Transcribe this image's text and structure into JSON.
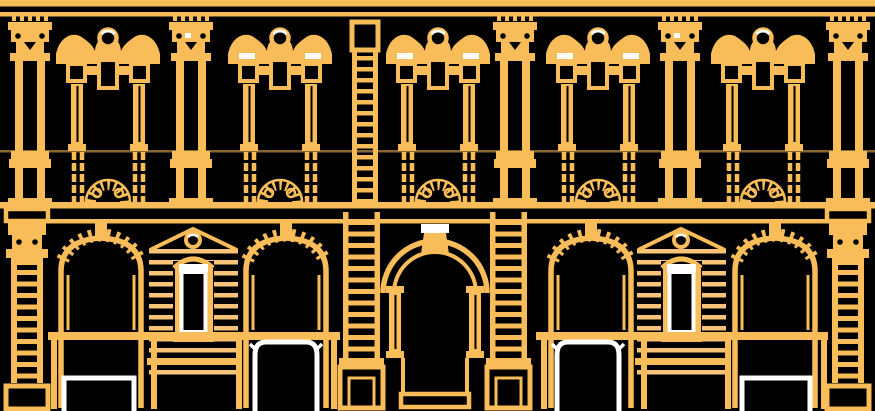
{
  "scene": {
    "type": "architectural-elevation-line-drawing",
    "subject": "two-story baroque palazzo facade, gold line art on black",
    "background_color": "#000000",
    "palette": {
      "gold": "#F8BC58",
      "pale_gold": "#F9C477",
      "white": "#FFFFFF",
      "black": "#000000"
    }
  },
  "facade": {
    "upper_floor": {
      "pilasters": 5,
      "french_windows": 5,
      "scroll_pediments": 5,
      "pediment_medallions": 5,
      "rusticated_quoin_chain": 1,
      "balcony_railing_bays": 5,
      "white_highlight_ticks_on_windows": 3
    },
    "ground_floor": {
      "corner_pilasters": 2,
      "arched_openings": 4,
      "rusticated_panels": 2,
      "aedicule_windows_white_framed": 2,
      "central_portal": {
        "arched": true,
        "double_archivolt": true,
        "white_capped_keystone": true,
        "flanking_rusticated_pilasters": 2,
        "entry_step": true
      },
      "storefront_white_frames": 4
    },
    "entablatures": {
      "crowning_cornice": true,
      "balcony_string_course": true,
      "ground_floor_cornice": true,
      "storefront_lintel_band": true
    }
  }
}
